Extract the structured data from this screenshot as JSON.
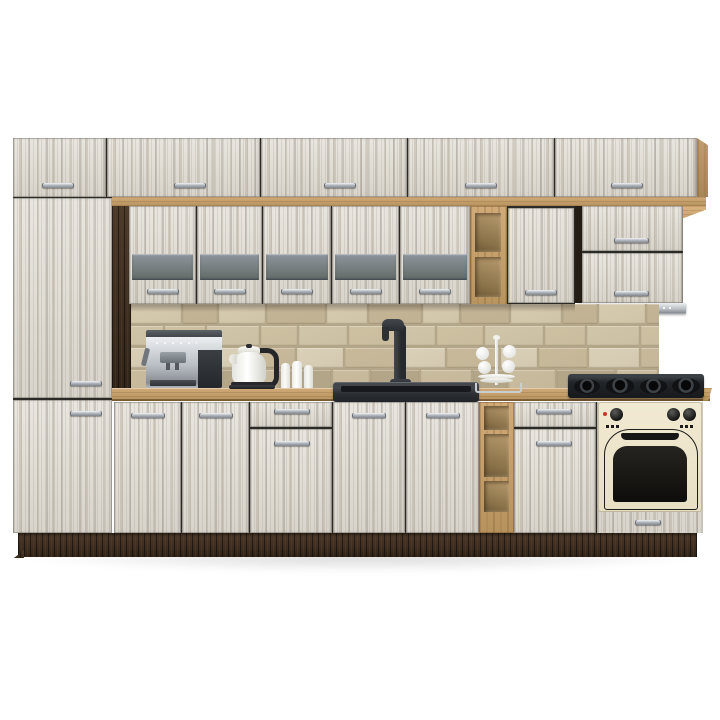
{
  "image_type": "product-render",
  "subject": "modular-kitchen-set",
  "palette": {
    "background": "#ffffff",
    "cabinet_wood_light": "#e9e6df",
    "cabinet_wood_dark": "#d8d4cb",
    "oak_light": "#d0aa78",
    "oak_dark": "#b6925d",
    "wenge_light": "#4c3a2a",
    "wenge_dark": "#31251a",
    "glass_light": "#8d959c",
    "glass_dark": "#69716f",
    "grout": "#b3a689",
    "steel": "#b9bfc5",
    "appliance_black": "#24272b",
    "oven_cream": "#f1ead2",
    "red_indicator": "#c2392b",
    "handle_chrome": "#a7adb3",
    "tile_shades": [
      "#d6cbaf",
      "#c9bc9e",
      "#d0c5a8",
      "#beb191",
      "#dad0b8",
      "#c3b495",
      "#b2a588",
      "#cec1a2",
      "#9a8d74",
      "#c7b999"
    ]
  },
  "scene": {
    "wall_units": {
      "top_row_doors": 5,
      "glass_strip_doors": 5,
      "plain_doors": 1,
      "flip_up_doors": 2,
      "open_shelf_compartments": 2
    },
    "base_units": {
      "doors": 6,
      "drawers": 3,
      "open_shelf_compartments": 3,
      "tall_cabinet_doors": 2
    },
    "appliances": [
      "coffee-machine",
      "electric-kettle",
      "kitchen-sink",
      "mixer-tap",
      "mug-stand",
      "candles",
      "range-hood",
      "gas-hob",
      "built-in-oven"
    ]
  }
}
